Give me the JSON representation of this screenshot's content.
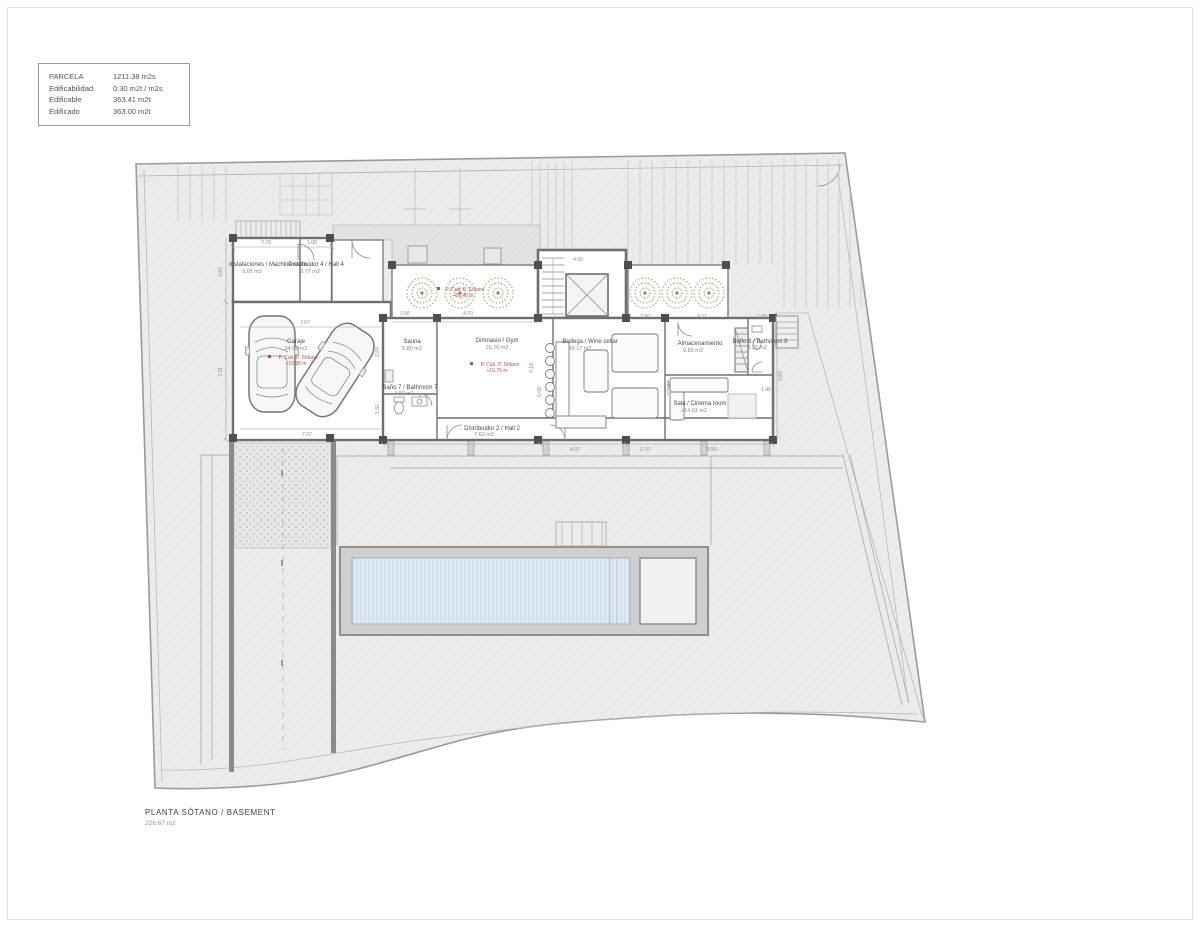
{
  "legend": {
    "rows": [
      {
        "label": "PARCELA",
        "value": "1211.38 m2s"
      },
      {
        "label": "Edificabilidad",
        "value": "0.30 m2t / m2s"
      },
      {
        "label": "Edificable",
        "value": "363.41 m2t"
      },
      {
        "label": "Edificado",
        "value": "363.00 m2t"
      }
    ]
  },
  "title_block": {
    "title": "PLANTA SÓTANO / BASEMENT",
    "area": "226.67 m2"
  },
  "rooms": {
    "machine_room": {
      "name": "Instalaciones / Machine room",
      "area": "9.01 m2"
    },
    "hall4": {
      "name": "Distribuidor 4 / Hall 4",
      "area": "3.77 m2"
    },
    "garage": {
      "name": "Garaje",
      "area": "34.96 m2",
      "note": "P. Cub. P. Sótano",
      "note2": "+15.88 m"
    },
    "patio": {
      "note": "P. Cub. P. Sótano",
      "note2": "+26.40 m"
    },
    "sauna": {
      "name": "Sauna",
      "area": "5.80 m2"
    },
    "gym": {
      "name": "Gimnasio / Gym",
      "area": "15.76 m2",
      "note": "P. Cub. P. Sótano",
      "note2": "+15.76 m"
    },
    "bath7": {
      "name": "Baño 7 / Bathroom 7",
      "area": "4.80 m2"
    },
    "hall2": {
      "name": "Distribuidor 2 / Hall 2",
      "area": "7.62 m2"
    },
    "bodega": {
      "name": "Bodega / Wine cellar",
      "area": "49.17 m2"
    },
    "storage": {
      "name": "Almacenamiento",
      "area": "9.80 m2"
    },
    "bath8": {
      "name": "Baño 8 / Bathroom 8",
      "area": "4.20 m2"
    },
    "cinema": {
      "name": "Sala / Cinema room",
      "area": "+14.01 m2"
    }
  },
  "dimensions": [
    "7.78",
    "1.08",
    "2.81",
    "7.11",
    "7.67",
    "1.06",
    "4.70",
    "4.00",
    "7.80",
    "9.11",
    "1.09",
    "2.84",
    "1.52",
    "4.10",
    "5.08",
    "4.97",
    "2.70",
    "5.50",
    "1.48",
    "3.83",
    "7.67"
  ],
  "colors": {
    "paper": "#ffffff",
    "terrain_fill": "#ececec",
    "wall": "#6f6f6f",
    "pool_water": "#e2ebf4",
    "plant": "#9aa06a",
    "accent_red": "#bc4f4a"
  }
}
